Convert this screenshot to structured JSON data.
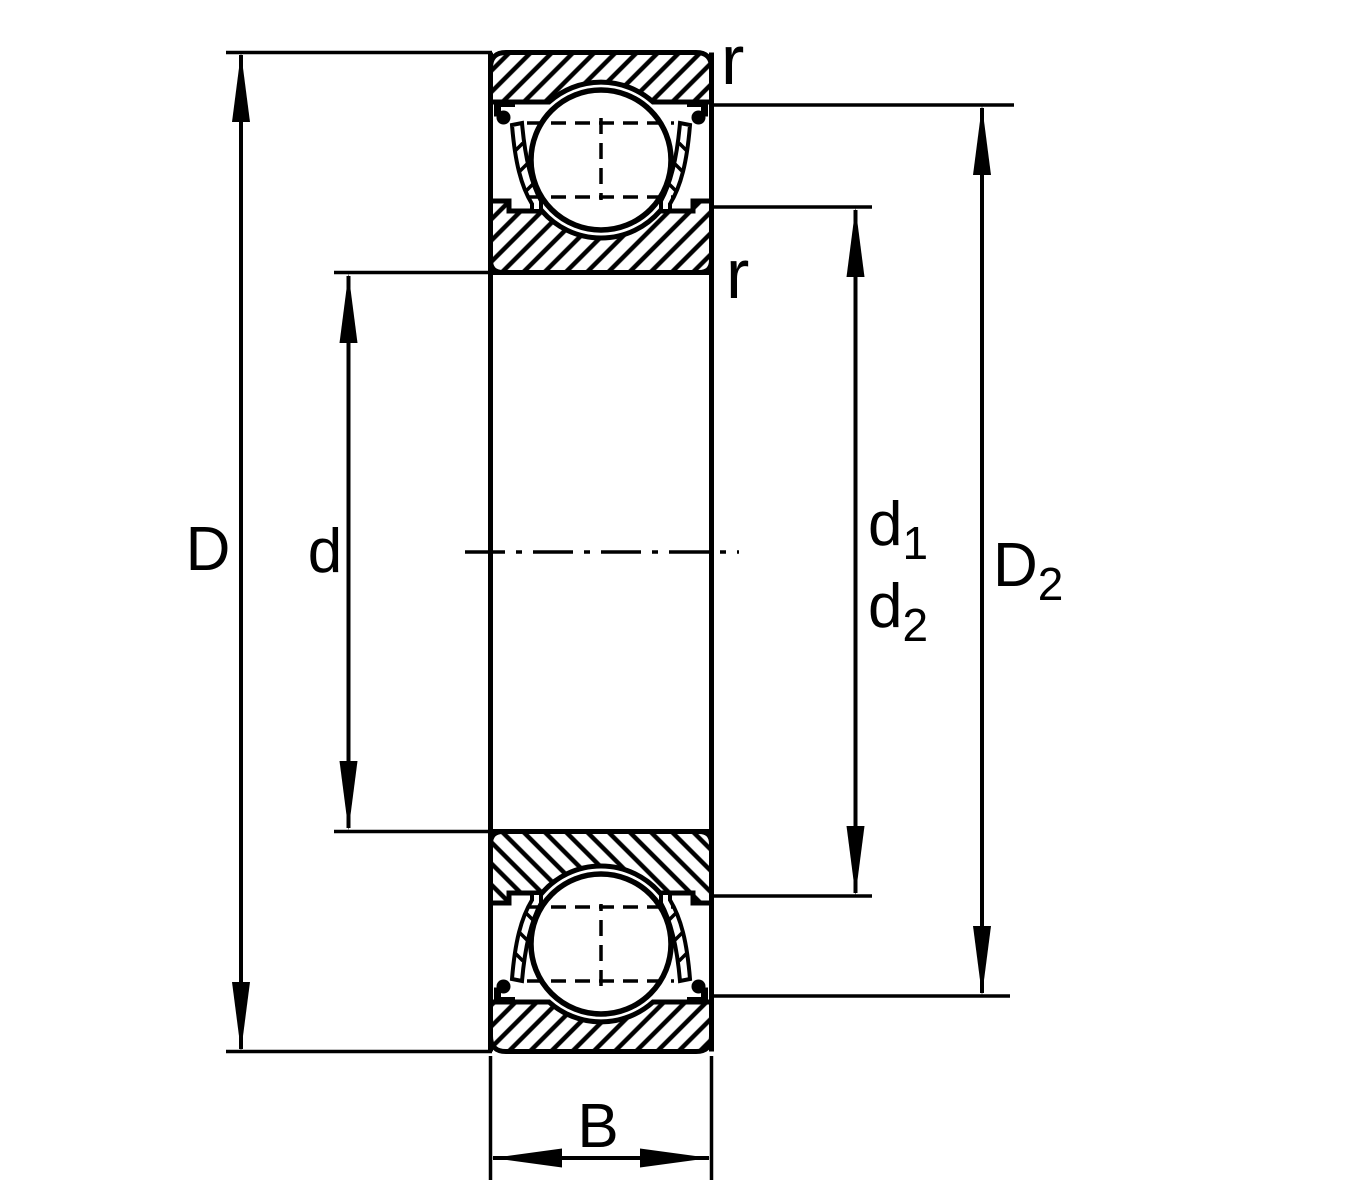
{
  "diagram": {
    "labels": {
      "outer_diameter": "D",
      "bore": "d",
      "width": "B",
      "d1": {
        "base": "d",
        "sub": "1"
      },
      "d2": {
        "base": "d",
        "sub": "2"
      },
      "D2": {
        "base": "D",
        "sub": "2"
      },
      "r_outer_corner": "r",
      "r_inner_corner": "r"
    },
    "colors": {
      "ink": "#000000",
      "paper": "#ffffff"
    }
  }
}
